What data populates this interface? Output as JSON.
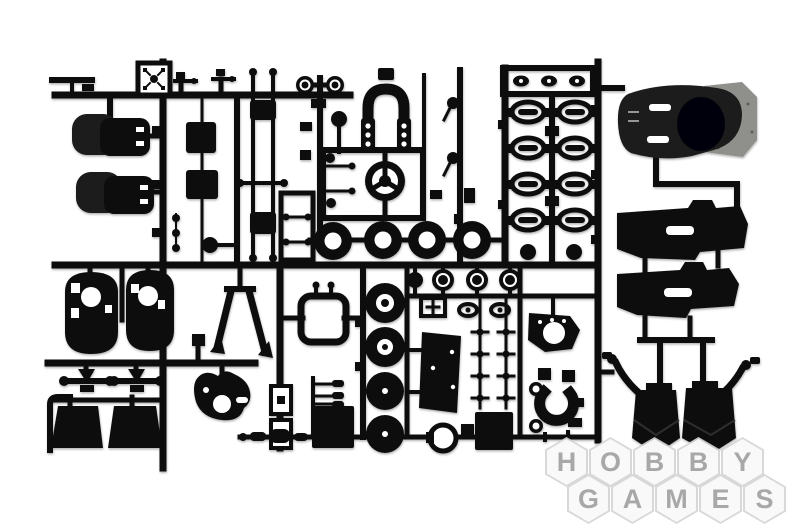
{
  "watermark": {
    "rows": [
      {
        "word": "HOBBY",
        "letters": [
          "H",
          "O",
          "B",
          "B",
          "Y"
        ]
      },
      {
        "word": "GAMES",
        "letters": [
          "G",
          "A",
          "M",
          "E",
          "S"
        ]
      }
    ]
  },
  "colors": {
    "photo-bg": "#ffffff",
    "plastic": "#101010",
    "plastic-soft": "#1a1a1a",
    "metal-backing": "#8f8f8b",
    "hex-border": "rgba(213,213,213,0.92)",
    "hex-fill": "rgba(255,255,255,0.85)",
    "hex-letter": "#a8a8a8"
  }
}
